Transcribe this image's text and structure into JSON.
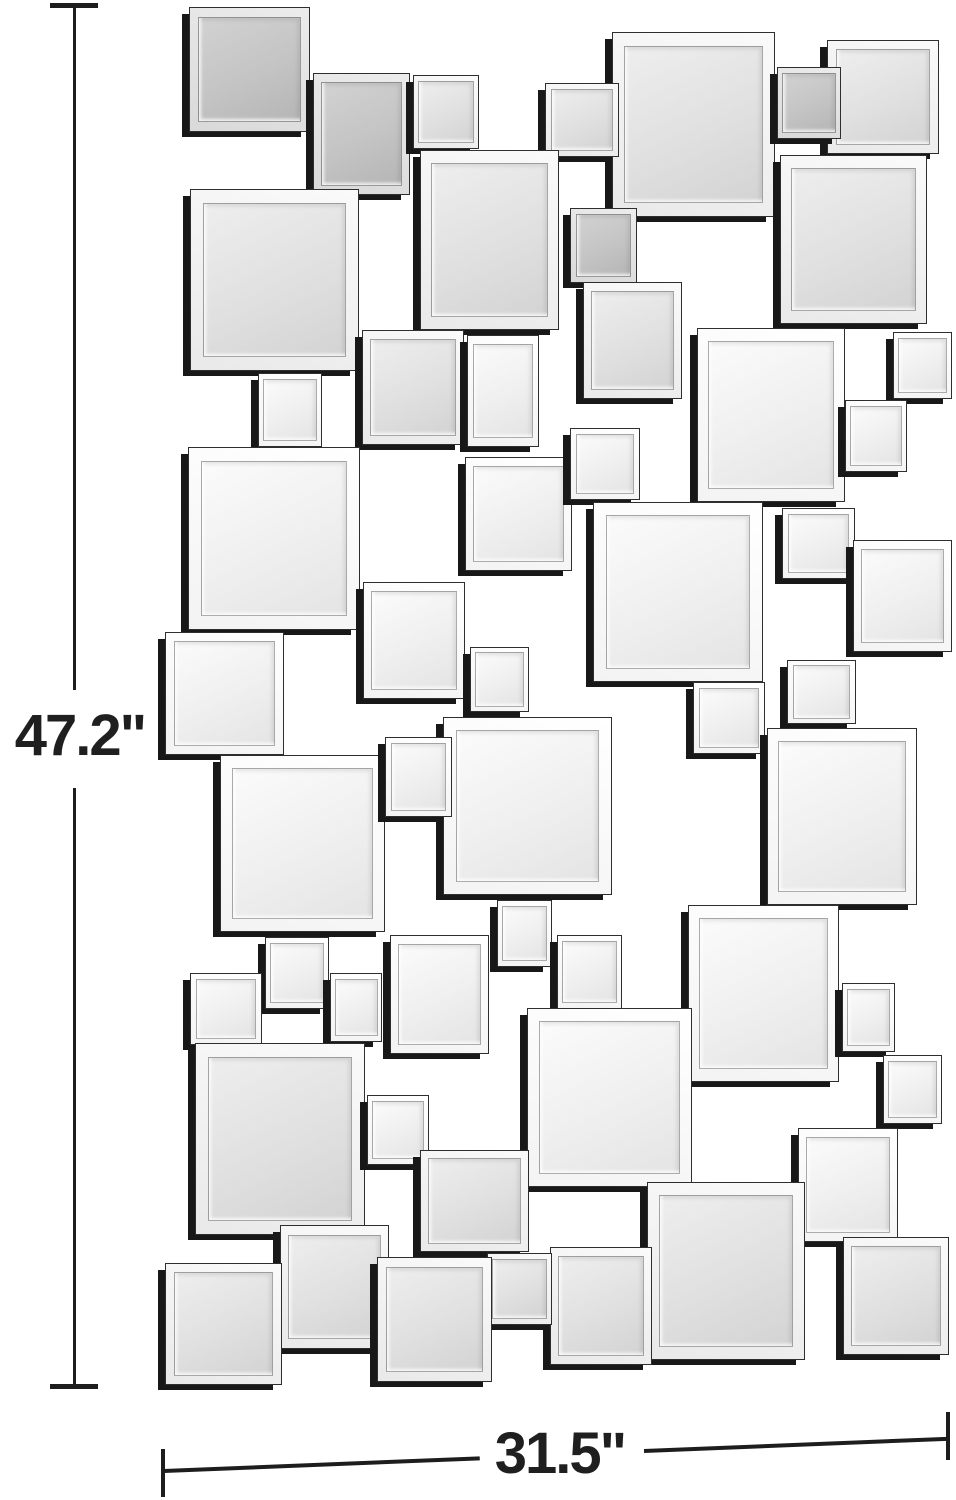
{
  "dimensions": {
    "height_label": "47.2\"",
    "width_label": "31.5\""
  },
  "colors": {
    "background": "#ffffff",
    "dimension_line": "#1d1d1d",
    "tile_depth_edge": "#181818",
    "tile_face_light": "#efefef",
    "tile_face_mid": "#e0e0e0",
    "tile_face_gray": "#c4c4c4"
  },
  "mirror": {
    "description": "wall collage of beveled square mirror tiles",
    "tile_count": 54,
    "squares": [
      [
        189,
        7,
        119,
        123,
        "g"
      ],
      [
        313,
        73,
        95,
        120,
        "g"
      ],
      [
        413,
        75,
        64,
        72,
        "m"
      ],
      [
        612,
        32,
        161,
        183,
        "m"
      ],
      [
        545,
        83,
        72,
        72,
        "m"
      ],
      [
        827,
        40,
        110,
        112,
        "m"
      ],
      [
        777,
        67,
        62,
        70,
        "g"
      ],
      [
        420,
        150,
        137,
        178,
        "m"
      ],
      [
        190,
        189,
        167,
        180,
        "m"
      ],
      [
        570,
        208,
        65,
        73,
        "g"
      ],
      [
        780,
        155,
        145,
        167,
        "m"
      ],
      [
        583,
        282,
        97,
        115,
        "m"
      ],
      [
        697,
        328,
        146,
        172,
        "w"
      ],
      [
        893,
        332,
        57,
        65,
        "w"
      ],
      [
        258,
        373,
        62,
        72,
        "w"
      ],
      [
        362,
        330,
        100,
        113,
        "m"
      ],
      [
        467,
        335,
        70,
        110,
        "w"
      ],
      [
        845,
        400,
        60,
        70,
        "w"
      ],
      [
        188,
        447,
        170,
        181,
        "w"
      ],
      [
        465,
        457,
        105,
        112,
        "w"
      ],
      [
        570,
        428,
        68,
        70,
        "w"
      ],
      [
        593,
        502,
        168,
        178,
        "w"
      ],
      [
        782,
        508,
        71,
        69,
        "w"
      ],
      [
        853,
        540,
        97,
        110,
        "w"
      ],
      [
        363,
        582,
        100,
        115,
        "w"
      ],
      [
        165,
        632,
        117,
        121,
        "w"
      ],
      [
        470,
        647,
        57,
        63,
        "w"
      ],
      [
        787,
        660,
        67,
        62,
        "w"
      ],
      [
        693,
        682,
        70,
        70,
        "w"
      ],
      [
        443,
        717,
        167,
        176,
        "w"
      ],
      [
        767,
        728,
        148,
        175,
        "w"
      ],
      [
        220,
        755,
        163,
        175,
        "w"
      ],
      [
        385,
        737,
        65,
        78,
        "w"
      ],
      [
        497,
        900,
        53,
        65,
        "w"
      ],
      [
        688,
        905,
        149,
        175,
        "w"
      ],
      [
        390,
        935,
        97,
        117,
        "w"
      ],
      [
        557,
        935,
        63,
        72,
        "w"
      ],
      [
        265,
        937,
        62,
        70,
        "w"
      ],
      [
        190,
        973,
        70,
        70,
        "w"
      ],
      [
        330,
        973,
        50,
        67,
        "w"
      ],
      [
        842,
        983,
        51,
        67,
        "w"
      ],
      [
        527,
        1008,
        163,
        177,
        "w"
      ],
      [
        195,
        1043,
        168,
        190,
        "m"
      ],
      [
        883,
        1055,
        57,
        67,
        "w"
      ],
      [
        367,
        1095,
        60,
        68,
        "w"
      ],
      [
        798,
        1128,
        98,
        112,
        "w"
      ],
      [
        420,
        1150,
        107,
        100,
        "m"
      ],
      [
        647,
        1182,
        156,
        176,
        "m"
      ],
      [
        280,
        1225,
        107,
        122,
        "m"
      ],
      [
        843,
        1237,
        104,
        116,
        "m"
      ],
      [
        550,
        1247,
        100,
        116,
        "m"
      ],
      [
        487,
        1253,
        63,
        70,
        "m"
      ],
      [
        165,
        1263,
        115,
        120,
        "m"
      ],
      [
        377,
        1257,
        113,
        123,
        "m"
      ]
    ]
  }
}
